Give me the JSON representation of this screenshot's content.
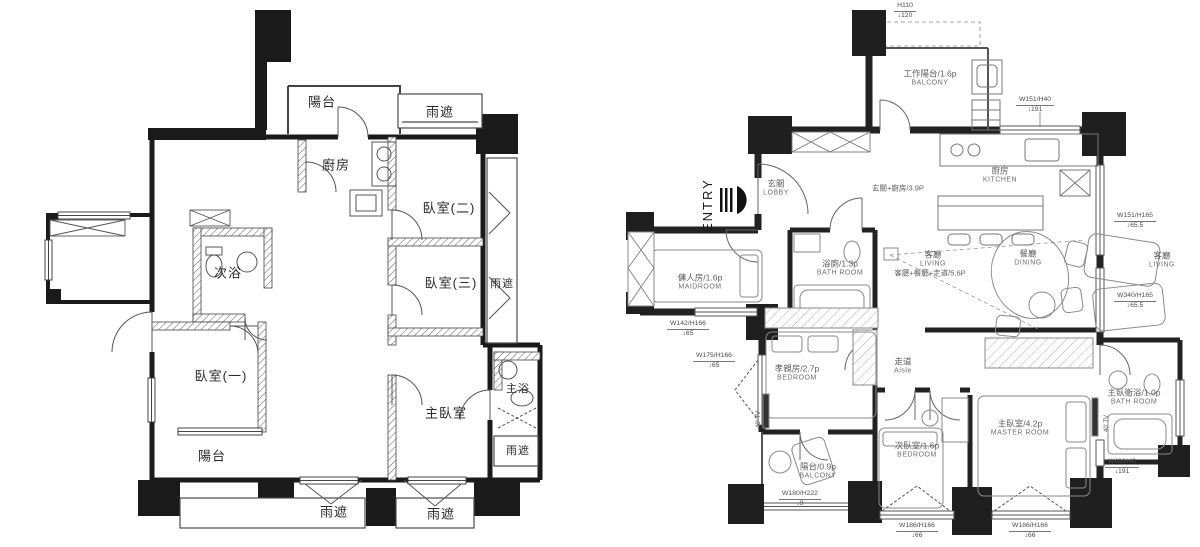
{
  "document": {
    "title": "Apartment floor plans — original layout (left) and renovated furniture layout (right)"
  },
  "left_plan": {
    "labels": {
      "balcony_top": "陽台",
      "canopy_top": "雨遮",
      "kitchen": "廚房",
      "bedroom_2": "臥室(二)",
      "second_bath": "次浴",
      "bedroom_3": "臥室(三)",
      "canopy_right_upper": "雨遮",
      "bedroom_1": "臥室(一)",
      "master_bedroom": "主臥室",
      "master_bath": "主浴",
      "canopy_right_lower": "雨遮",
      "balcony_bottom": "陽台",
      "canopy_bottom_left": "雨遮",
      "canopy_bottom_right": "雨遮"
    }
  },
  "right_plan": {
    "entry_label": "ENTRY",
    "rooms": {
      "work_balcony": {
        "zh": "工作陽台/1.6p",
        "en": "BALCONY"
      },
      "lobby": {
        "zh": "玄關",
        "en": "LOBBY"
      },
      "kitchen": {
        "zh": "廚房",
        "en": "KITCHEN"
      },
      "living_projection": {
        "zh": "客廳",
        "en": "LIVING"
      },
      "dining": {
        "zh": "餐廳",
        "en": "DINING"
      },
      "living": {
        "zh": "客廳",
        "en": "LIVING"
      },
      "maid_room": {
        "zh": "傭人房/1.6p",
        "en": "MAIDROOM"
      },
      "bath_room": {
        "zh": "浴廁/1.3p",
        "en": "BATH ROOM"
      },
      "parents_room": {
        "zh": "孝親房/2.7p",
        "en": "BEDROOM"
      },
      "aisle": {
        "zh": "走道",
        "en": "Aisle"
      },
      "bedroom_2": {
        "zh": "次臥室/1.6p",
        "en": "BEDROOM"
      },
      "master_room": {
        "zh": "主臥室/4.2p",
        "en": "MASTER ROOM"
      },
      "master_bath": {
        "zh": "主臥衛浴/1.0p",
        "en": "BATH ROOM"
      },
      "balcony": {
        "zh": "陽台/0.9p",
        "en": "BALCONY"
      }
    },
    "area_notes": {
      "entry_kitchen": "玄關+廚房/3.9P",
      "living_dining_aisle": "客廳+餐廳+走道/5.6P"
    },
    "tv_notes": {
      "left": "40' TV",
      "right": "40' TV"
    },
    "window_annotations": {
      "top": {
        "size": "H110",
        "sill": "↓120"
      },
      "top_right": {
        "size": "W151/H40",
        "sill": "↓191"
      },
      "right_upper": {
        "size": "W151/H165",
        "sill": "↓65.5"
      },
      "right_lower": {
        "size": "W340/H165",
        "sill": "↓65.5"
      },
      "left_upper": {
        "size": "W142/H166",
        "sill": "↓65"
      },
      "left_lower": {
        "size": "W175/H166",
        "sill": "↓65"
      },
      "bottom_left": {
        "size": "W180/H222",
        "sill": "↓9"
      },
      "bottom_middle": {
        "size": "W186/H166",
        "sill": "↓66"
      },
      "bottom_right": {
        "size": "W186/H166",
        "sill": "↓66"
      },
      "corner_right": {
        "size": "W48/H40",
        "sill": "↓191"
      }
    }
  }
}
